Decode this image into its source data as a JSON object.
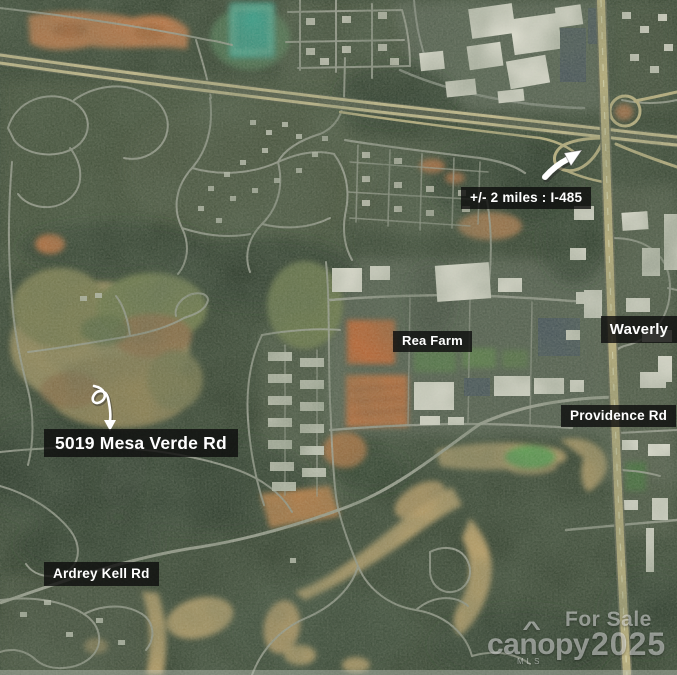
{
  "map": {
    "annotations": {
      "i485_distance": "+/- 2 miles : I-485",
      "rea_farm": "Rea Farm",
      "waverly": "Waverly",
      "providence_rd": "Providence Rd",
      "property_address": "5019 Mesa Verde Rd",
      "ardrey_kell_rd": "Ardrey Kell Rd"
    },
    "watermark": {
      "line1": "For Sale",
      "brand": "canopy",
      "brand_accent": "^",
      "brand_sub": "MLS",
      "year": "2025"
    },
    "palette": {
      "label_bg": "#0c0c0c",
      "label_text": "#ffffff",
      "highway": "#d7c893",
      "local_road": "#a9ab9f",
      "forest": "#2c3a28",
      "open_field": "#9a8a58",
      "bare_dirt": "#c4703a",
      "golf_fairway": "#c9a76a",
      "sports_court": "#2f9f8a",
      "annotation_arrow": "#ffffff"
    }
  }
}
